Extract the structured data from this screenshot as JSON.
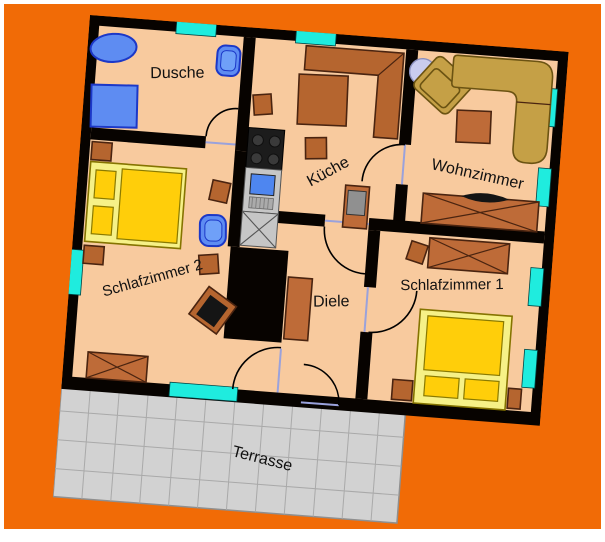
{
  "title": "Wohnung Grundriss",
  "colors": {
    "background_orange": "#F16B06",
    "page_frame_white": "#FFFFFF",
    "wall_black": "#070300",
    "floor_peach": "#F8CA9E",
    "window_cyan": "#1FECDE",
    "terrace_gray": "#D2D2D2",
    "terrace_line_gray": "#A9A9A9",
    "furniture_brown": "#B5652F",
    "furniture_brown_dark": "#4A2410",
    "bed_frame_yellow": "#F6F187",
    "bed_mattress_yellow": "#FFCE0A",
    "sofa_gold": "#C5A046",
    "fixture_blue": "#5E8CF2",
    "metal_gray": "#C6C6C6",
    "door_threshold_blue": "#9AA2DC",
    "label_text": "#111111"
  },
  "rooms": {
    "dusche": {
      "label": "Dusche"
    },
    "kueche": {
      "label": "Küche"
    },
    "wohnzimmer": {
      "label": "Wohnzimmer"
    },
    "schlafzimmer1": {
      "label": "Schlafzimmer 1"
    },
    "schlafzimmer2": {
      "label": "Schlafzimmer 2"
    },
    "diele": {
      "label": "Diele"
    },
    "terrasse": {
      "label": "Terrasse"
    }
  },
  "furniture_icons": [
    "bathtub-icon",
    "toilet-icon",
    "shower-icon",
    "stove-icon",
    "sink-icon",
    "kitchen-cabinet-icon",
    "corner-bench-icon",
    "kitchen-table-icon",
    "stool-icon",
    "floor-lamp-icon",
    "armchair-icon",
    "corner-sofa-icon",
    "coffee-table-icon",
    "tv-sideboard-icon",
    "tv-icon",
    "wardrobe-icon",
    "double-bed-icon",
    "pillow-icon",
    "nightstand-icon",
    "chair-icon",
    "dresser-icon",
    "chimney-block",
    "window-marker",
    "door-arc"
  ]
}
